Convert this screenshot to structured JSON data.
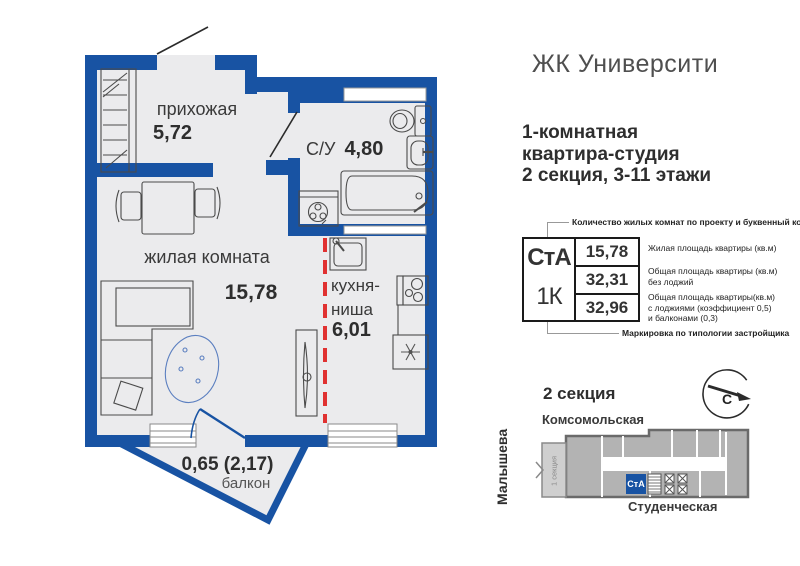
{
  "header": {
    "title": "ЖК Университи",
    "subtitle": "1-комнатная\nквартира-студия\n2 секция, 3-11 этажи"
  },
  "plan": {
    "hallway": {
      "name": "прихожая",
      "area": "5,72"
    },
    "bathroom": {
      "name": "С/У",
      "area": "4,80"
    },
    "living": {
      "name": "жилая комната",
      "area": "15,78"
    },
    "kitchen": {
      "name": "кухня-\nниша",
      "area": "6,01"
    },
    "balcony": {
      "name": "балкон",
      "area": "0,65 (2,17)"
    }
  },
  "info_table": {
    "type_code": "СтА",
    "rooms_code": "1К",
    "values": [
      "15,78",
      "32,31",
      "32,96"
    ],
    "top_label": "Количество жилых комнат по проекту и буквенный код",
    "bottom_label": "Маркировка по типологии застройщика",
    "row_labels": [
      "Жилая площадь квартиры (кв.м)",
      "Общая площадь квартиры (кв.м)\nбез лоджий",
      "Общая площадь квартиры(кв.м)\nс лоджиями (коэффициент 0,5)\nи балконами (0,3)"
    ]
  },
  "section_map": {
    "title": "2 секция",
    "street_top": "Комсомольская",
    "street_left": "Малышева",
    "street_bottom": "Студенческая",
    "section_label": "1 секция",
    "unit_label": "СтА",
    "compass_label": "С"
  },
  "colors": {
    "wall_blue": "#1853a3",
    "red_dashed": "#e03131",
    "room_fill": "#ebebed",
    "building_gray": "#b3b3b3"
  }
}
